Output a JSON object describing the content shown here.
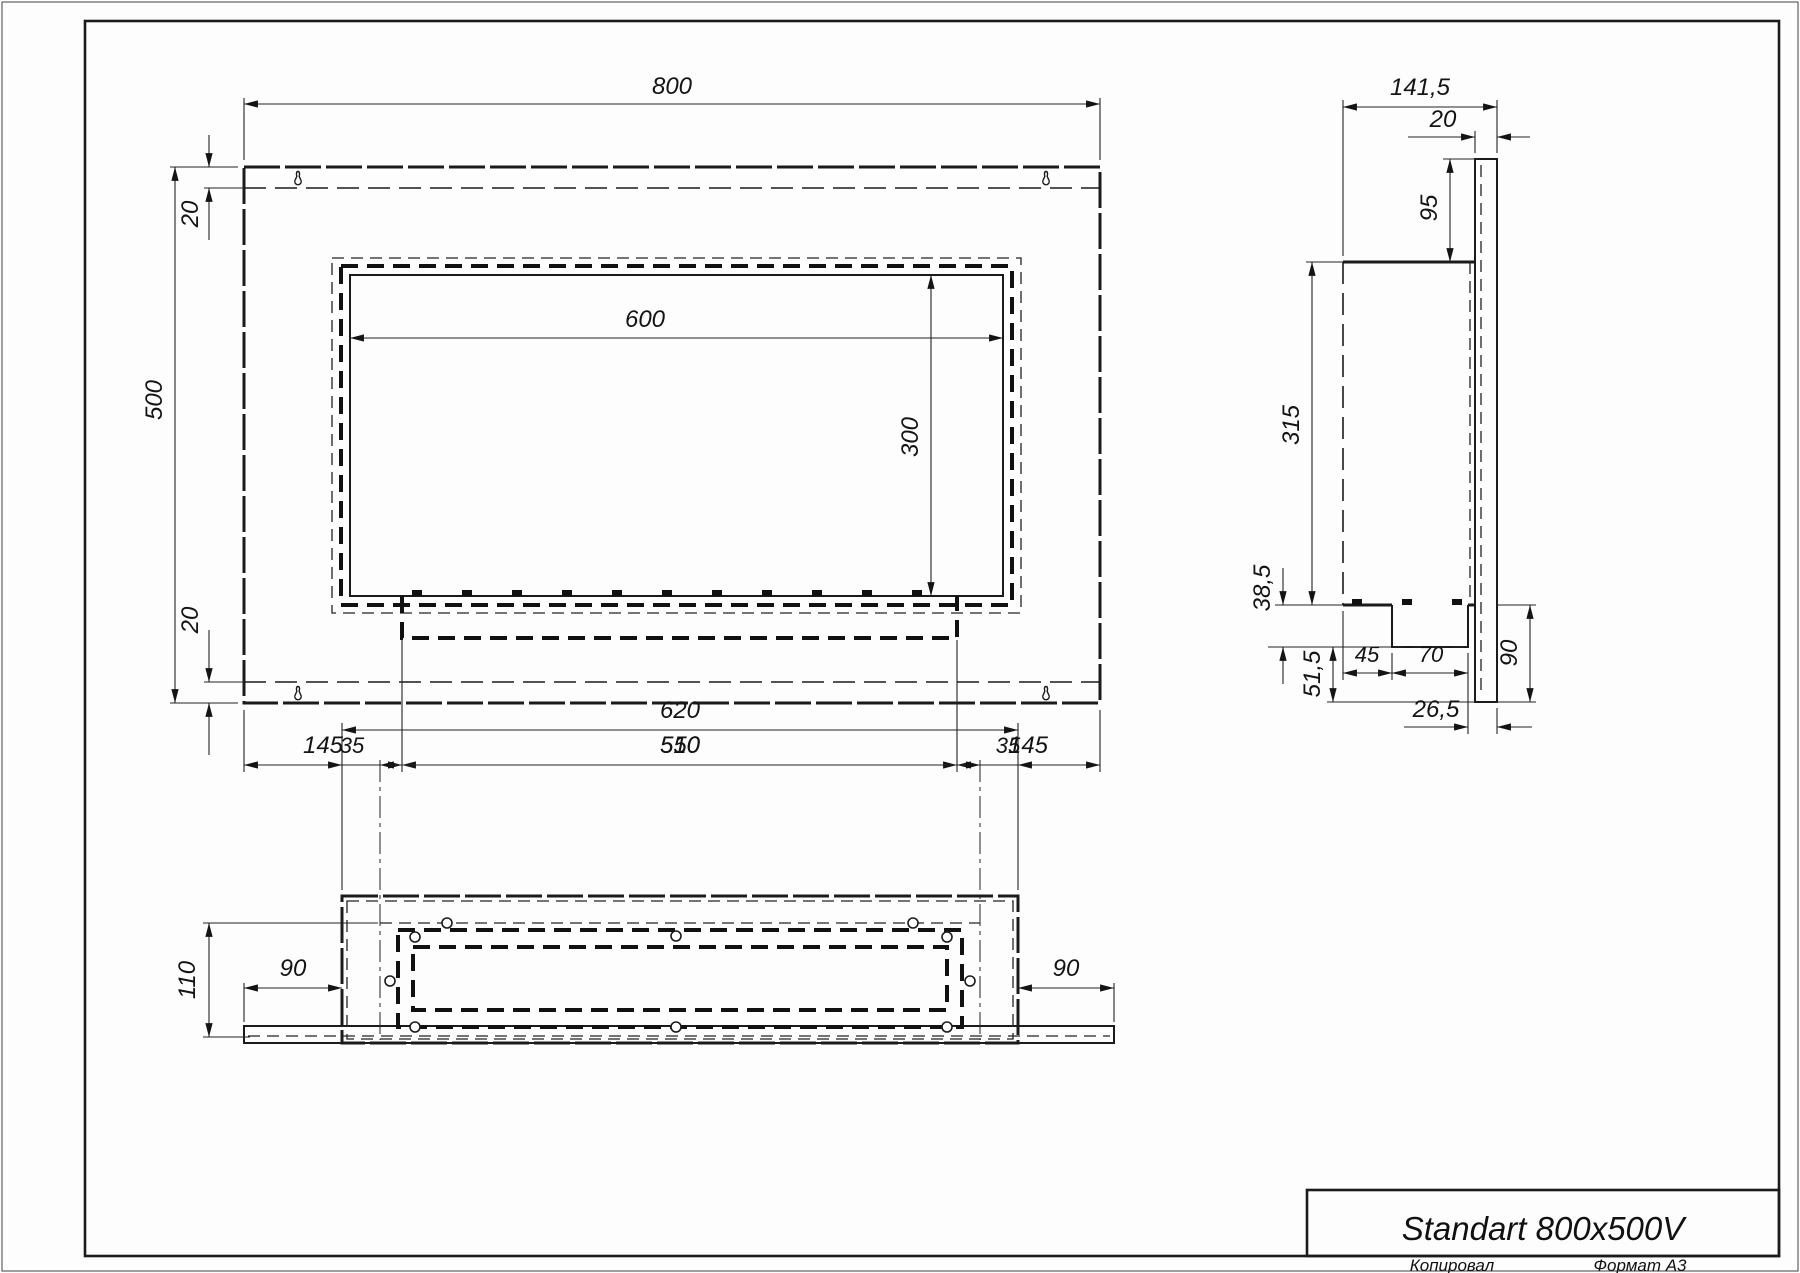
{
  "title_block": {
    "title": "Standart 800x500V",
    "copied_label": "Копировал",
    "format_label": "Формат А3"
  },
  "front_view": {
    "overall_width": "800",
    "overall_height": "500",
    "top_gap": "20",
    "bottom_gap": "20",
    "opening_width": "600",
    "opening_height": "300",
    "left_to_tray": "145",
    "tray_width": "510",
    "tray_to_right": "145"
  },
  "side_view": {
    "overall_depth": "141,5",
    "back_plate_thickness": "20",
    "plate_above_body": "95",
    "body_height": "315",
    "tray_depth": "38,5",
    "tray_to_plate_bottom": "51,5",
    "body_to_tray": "45",
    "tray_width": "70",
    "plate_below_body": "90",
    "tray_to_back": "26,5"
  },
  "bottom_view": {
    "box_width": "620",
    "inner_width": "550",
    "margin_left": "35",
    "margin_right": "35",
    "depth": "110",
    "flange_left": "90",
    "flange_right": "90"
  }
}
